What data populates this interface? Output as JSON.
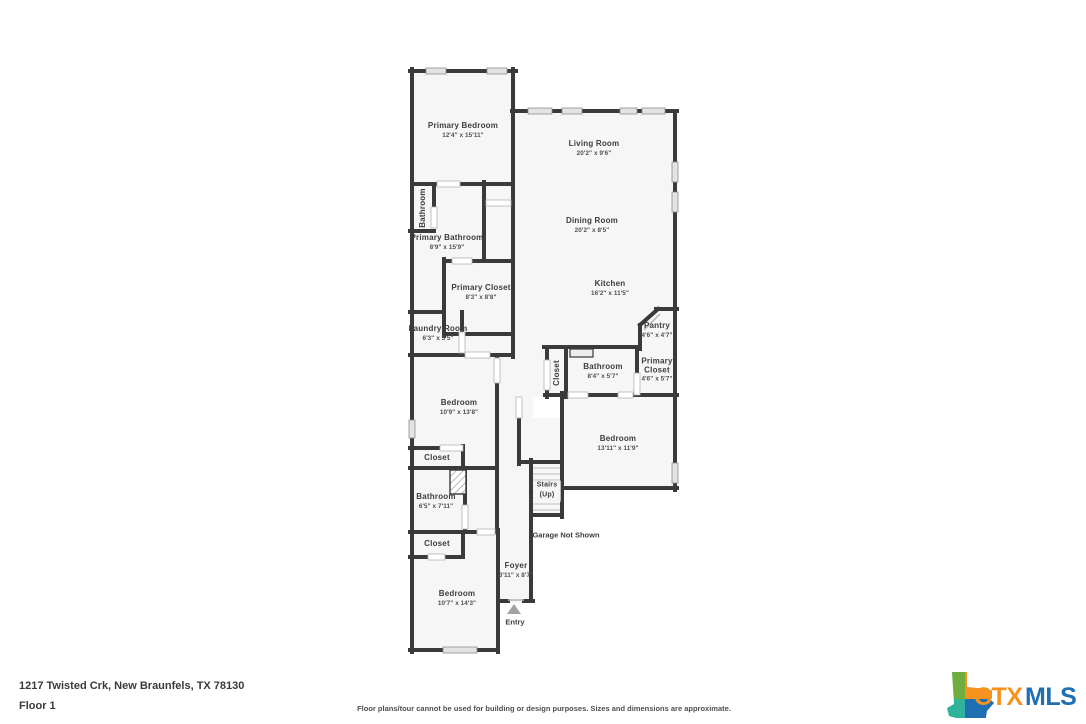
{
  "address": "1217 Twisted Crk, New Braunfels, TX 78130",
  "floor_label": "Floor 1",
  "disclaimer": "Floor plans/tour cannot be used for building or design purposes. Sizes and dimensions are approximate.",
  "logo": {
    "ctx": "CTX",
    "mls": "MLS",
    "ctx_color": "#F6921E",
    "mls_color": "#1F6FB3",
    "texas_green": "#6FAE3E",
    "texas_orange": "#F6921E",
    "texas_teal": "#2FB39B",
    "texas_blue": "#1F6FB3"
  },
  "plan": {
    "colors": {
      "wall": "#3A3A3A",
      "floor": "#F6F6F6",
      "window_fill": "#E3E3E3",
      "window_stroke": "#8C8C8C",
      "door_stroke": "#B5B5B5",
      "step_line": "#C9C9C9",
      "entry_arrow": "#A3A3A3"
    },
    "rooms": {
      "primary_bedroom": {
        "name": "Primary Bedroom",
        "dims": "12'4\" x 15'11\""
      },
      "living_room": {
        "name": "Living Room",
        "dims": "20'2\" x 9'6\""
      },
      "dining_room": {
        "name": "Dining Room",
        "dims": "20'2\" x 8'5\""
      },
      "kitchen": {
        "name": "Kitchen",
        "dims": "16'2\" x 11'5\""
      },
      "pantry": {
        "name": "Pantry",
        "dims": "4'6\" x 4'7\""
      },
      "bathroom_1": {
        "name": "Bathroom",
        "dims": ""
      },
      "primary_bathroom": {
        "name": "Primary Bathroom",
        "dims": "8'9\" x 15'9\""
      },
      "primary_closet_1": {
        "name": "Primary Closet",
        "dims": "8'3\" x 8'8\""
      },
      "laundry_room": {
        "name": "Laundry Room",
        "dims": "6'3\" x 5'5\""
      },
      "closet_hall": {
        "name": "Closet",
        "dims": ""
      },
      "bathroom_2": {
        "name": "Bathroom",
        "dims": "8'4\" x 5'7\""
      },
      "primary_closet_2": {
        "name": "Primary Closet",
        "dims": "4'6\" x 5'7\""
      },
      "bedroom_1": {
        "name": "Bedroom",
        "dims": "10'9\" x 13'8\""
      },
      "bedroom_2": {
        "name": "Bedroom",
        "dims": "13'11\" x 11'9\""
      },
      "closet_1": {
        "name": "Closet",
        "dims": ""
      },
      "bathroom_3": {
        "name": "Bathroom",
        "dims": "6'5\" x 7'11\""
      },
      "closet_2": {
        "name": "Closet",
        "dims": ""
      },
      "bedroom_3": {
        "name": "Bedroom",
        "dims": "10'7\" x 14'3\""
      },
      "foyer": {
        "name": "Foyer",
        "dims": "3'11\" x 8'7\""
      }
    },
    "annotations": {
      "stairs_line1": "Stairs",
      "stairs_line2": "(Up)",
      "garage_note": "Garage Not Shown",
      "entry": "Entry"
    }
  }
}
